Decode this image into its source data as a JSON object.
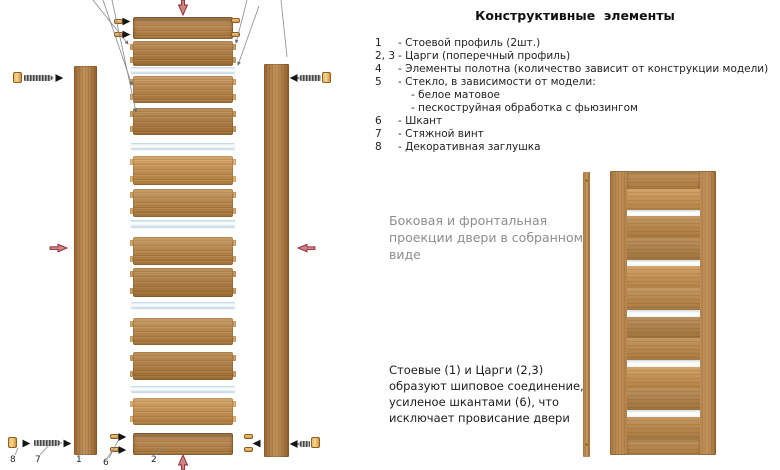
{
  "title": "Конструктивные  элементы",
  "parts_list": [
    {
      "num": "1",
      "desc": "- Стоевой профиль (2шт.)",
      "sub": []
    },
    {
      "num": "2, 3",
      "desc": "- Царги (поперечный профиль)",
      "sub": []
    },
    {
      "num": "4",
      "desc": "- Элементы полотна (количество зависит от конструкции модели)",
      "sub": []
    },
    {
      "num": "5",
      "desc": "- Стекло, в зависимости от модели:",
      "sub": [
        "- белое матовое",
        "- пескоструйная обработка с фьюзингом"
      ]
    },
    {
      "num": "6",
      "desc": "- Шкант",
      "sub": []
    },
    {
      "num": "7",
      "desc": "- Стяжной винт",
      "sub": []
    },
    {
      "num": "8",
      "desc": "- Декоративная заглушка",
      "sub": []
    }
  ],
  "notes": {
    "projection": "Боковая и фронтальная\nпроекции двери в собранном\nвиде",
    "joint": "Стоевые (1) и Царги (2,3)\nобразуют шиповое соединение,\nусиленое шкантами (6), что\nисключает провисание двери"
  },
  "diagram": {
    "callouts": [
      {
        "label": "8",
        "x": 10,
        "y": 455
      },
      {
        "label": "7",
        "x": 35,
        "y": 455
      },
      {
        "label": "1",
        "x": 76,
        "y": 455
      },
      {
        "label": "6",
        "x": 103,
        "y": 458
      },
      {
        "label": "2",
        "x": 151,
        "y": 455
      }
    ],
    "stack": [
      {
        "t": "rail",
        "y": 17,
        "h": 22,
        "tone": "a"
      },
      {
        "t": "panel",
        "y": 41,
        "h": 25,
        "tone": "c"
      },
      {
        "t": "glass",
        "y": 67,
        "h": 6
      },
      {
        "t": "panel",
        "y": 76,
        "h": 27,
        "tone": "a"
      },
      {
        "t": "panel",
        "y": 108,
        "h": 27,
        "tone": "c"
      },
      {
        "t": "glass",
        "y": 143,
        "h": 6
      },
      {
        "t": "panel",
        "y": 156,
        "h": 29,
        "tone": "b"
      },
      {
        "t": "panel",
        "y": 189,
        "h": 28,
        "tone": "a"
      },
      {
        "t": "glass",
        "y": 220,
        "h": 7
      },
      {
        "t": "panel",
        "y": 237,
        "h": 28,
        "tone": "a"
      },
      {
        "t": "panel",
        "y": 268,
        "h": 29,
        "tone": "c"
      },
      {
        "t": "glass",
        "y": 302,
        "h": 6
      },
      {
        "t": "panel",
        "y": 318,
        "h": 27,
        "tone": "a"
      },
      {
        "t": "panel",
        "y": 352,
        "h": 28,
        "tone": "c"
      },
      {
        "t": "glass",
        "y": 386,
        "h": 6
      },
      {
        "t": "panel",
        "y": 398,
        "h": 27,
        "tone": "b"
      },
      {
        "t": "rail",
        "y": 433,
        "h": 22,
        "tone": "a"
      }
    ],
    "dowels": [
      {
        "x": 114,
        "y": 19
      },
      {
        "x": 114,
        "y": 32
      },
      {
        "x": 231,
        "y": 18
      },
      {
        "x": 231,
        "y": 32
      },
      {
        "x": 110,
        "y": 434
      },
      {
        "x": 110,
        "y": 447
      },
      {
        "x": 244,
        "y": 434
      },
      {
        "x": 244,
        "y": 447
      }
    ],
    "screws": [
      {
        "x": 24,
        "y": 75,
        "w": 30,
        "dir": "r"
      },
      {
        "x": 297,
        "y": 75,
        "w": 24,
        "dir": "l"
      },
      {
        "x": 34,
        "y": 440,
        "w": 28,
        "dir": "r"
      },
      {
        "x": 297,
        "y": 441,
        "w": 13,
        "dir": "l"
      }
    ],
    "caps": [
      {
        "x": 13,
        "y": 72
      },
      {
        "x": 322,
        "y": 72
      },
      {
        "x": 8,
        "y": 437
      },
      {
        "x": 311,
        "y": 437
      }
    ],
    "door_front": [
      {
        "t": "rail",
        "h": 18,
        "tone": "a"
      },
      {
        "t": "panel",
        "h": 21,
        "tone": "b"
      },
      {
        "t": "glass",
        "h": 6
      },
      {
        "t": "panel",
        "h": 22,
        "tone": "a"
      },
      {
        "t": "panel",
        "h": 22,
        "tone": "c"
      },
      {
        "t": "glass",
        "h": 6
      },
      {
        "t": "panel",
        "h": 22,
        "tone": "b"
      },
      {
        "t": "panel",
        "h": 22,
        "tone": "a"
      },
      {
        "t": "glass",
        "h": 7
      },
      {
        "t": "panel",
        "h": 21,
        "tone": "c"
      },
      {
        "t": "panel",
        "h": 22,
        "tone": "a"
      },
      {
        "t": "glass",
        "h": 7
      },
      {
        "t": "panel",
        "h": 21,
        "tone": "b"
      },
      {
        "t": "panel",
        "h": 22,
        "tone": "c"
      },
      {
        "t": "glass",
        "h": 7
      },
      {
        "t": "panel",
        "h": 21,
        "tone": "a"
      },
      {
        "t": "rail",
        "h": 17,
        "tone": "a"
      }
    ],
    "colors": {
      "wood_light": "#c89e68",
      "wood_mid": "#b5854e",
      "wood_dark": "#9c6d39",
      "glass": "#eef6fb",
      "dowel": "#e3a858",
      "arrow_red": "#8c2030",
      "note_gray": "#8d8d8d"
    }
  }
}
